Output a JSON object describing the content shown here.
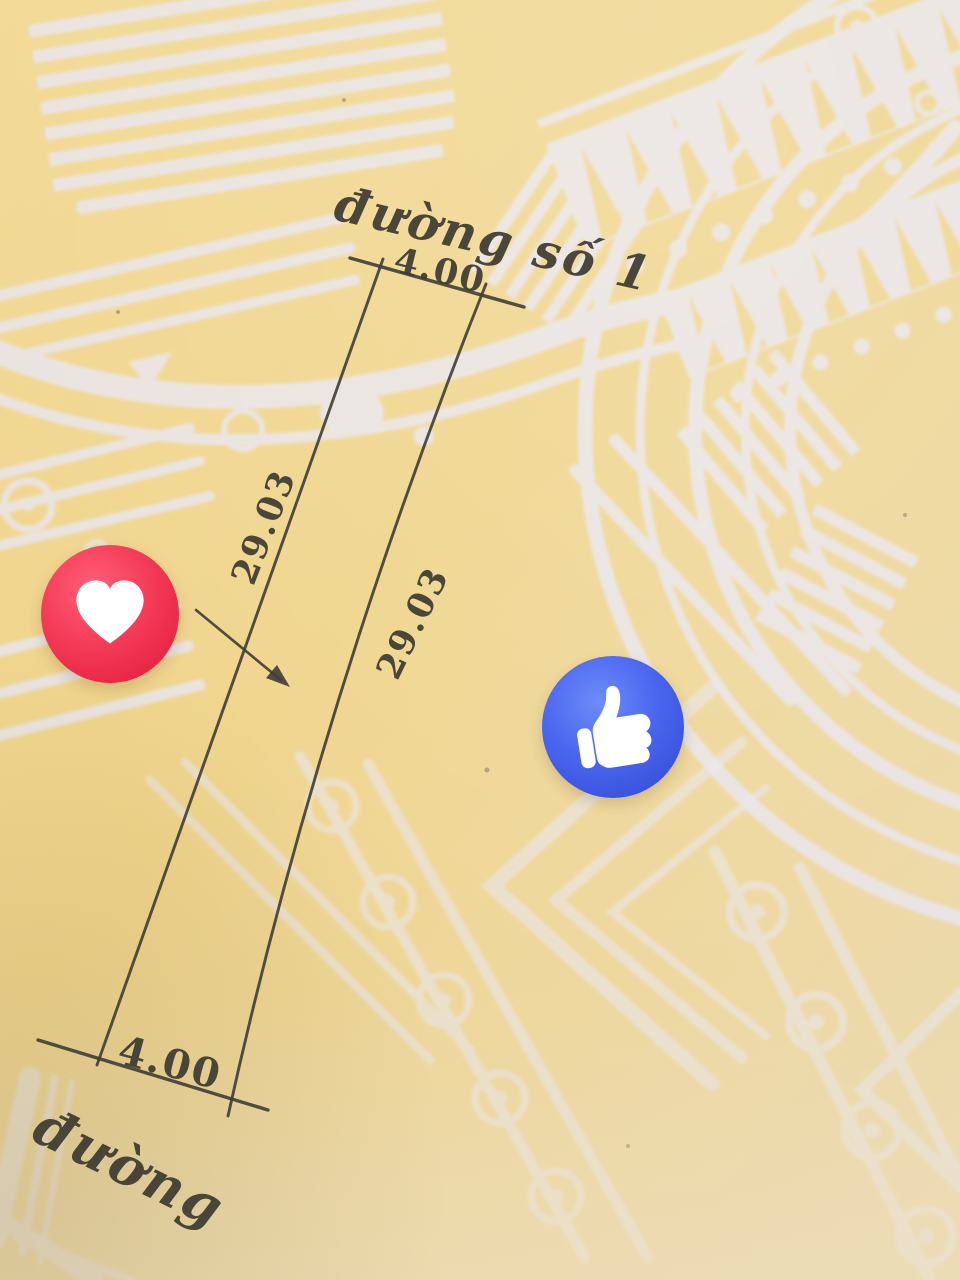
{
  "sketch": {
    "top_road_label": "đường số 1",
    "top_width": "4.00",
    "left_length": "29.03",
    "right_length": "29.03",
    "bottom_width": "4.00",
    "bottom_road_label": "đường"
  },
  "reactions": {
    "love": {
      "icon": "heart-icon",
      "label": "Love",
      "color": "#f03a55"
    },
    "like": {
      "icon": "thumbs-up-icon",
      "label": "Like",
      "color": "#4260ea"
    }
  },
  "colors": {
    "paper_yellow": "#efd58c",
    "pattern_white": "#e9e6ee",
    "ink": "#3f3d35",
    "love_red": "#f03a55",
    "like_blue": "#4260ea"
  }
}
